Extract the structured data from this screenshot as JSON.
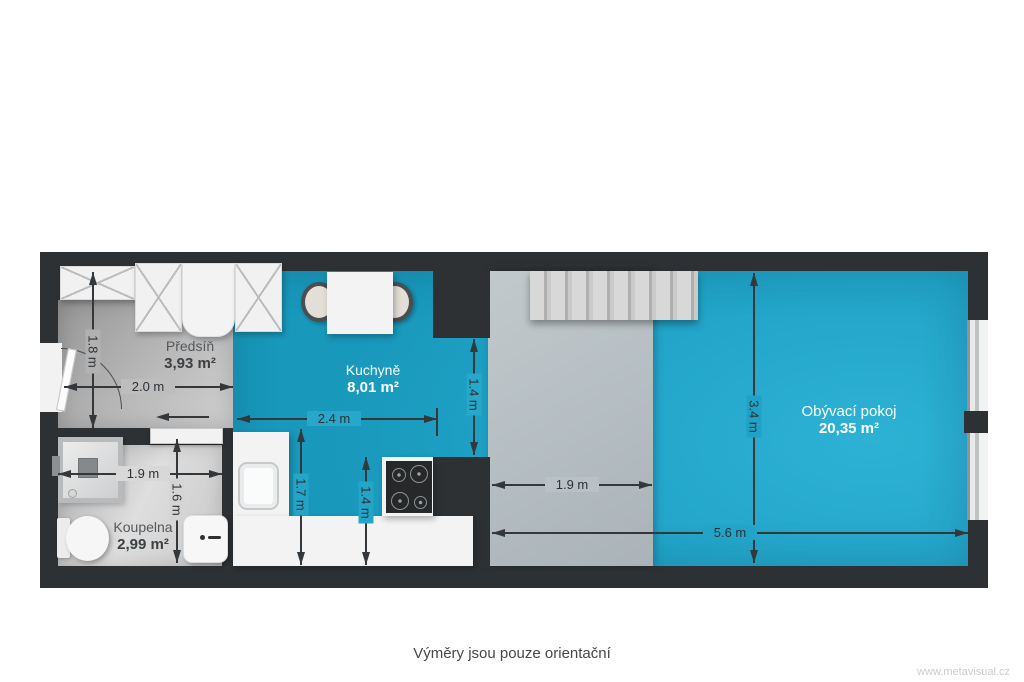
{
  "disclaimer": "Výměry jsou pouze orientační",
  "watermark": "www.metavisual.cz",
  "rooms": [
    {
      "name": "Předsíň",
      "area": "3,93 m²"
    },
    {
      "name": "Kuchyně",
      "area": "8,01 m²"
    },
    {
      "name": "Koupelna",
      "area": "2,99 m²"
    },
    {
      "name": "Obývací pokoj",
      "area": "20,35 m²"
    }
  ],
  "dims": {
    "hall_height": "1.8 m",
    "hall_width": "2.0 m",
    "kitchen_width": "2.4 m",
    "passage_height": "1.4 m",
    "bath_width": "1.9 m",
    "bath_height": "1.6 m",
    "counter_left_depth": "1.7 m",
    "counter_right_depth": "1.4 m",
    "platform_width": "1.9 m",
    "living_height": "3.4 m",
    "living_width": "5.6 m"
  },
  "colors": {
    "wall": "#2d3134",
    "floor_accent_teal": "#23a6c8",
    "floor_gray": "#b9b9b9",
    "platform_gray": "#b7c0c3",
    "furniture_white": "#f3f3f3",
    "dimension_ink": "#34383b"
  }
}
